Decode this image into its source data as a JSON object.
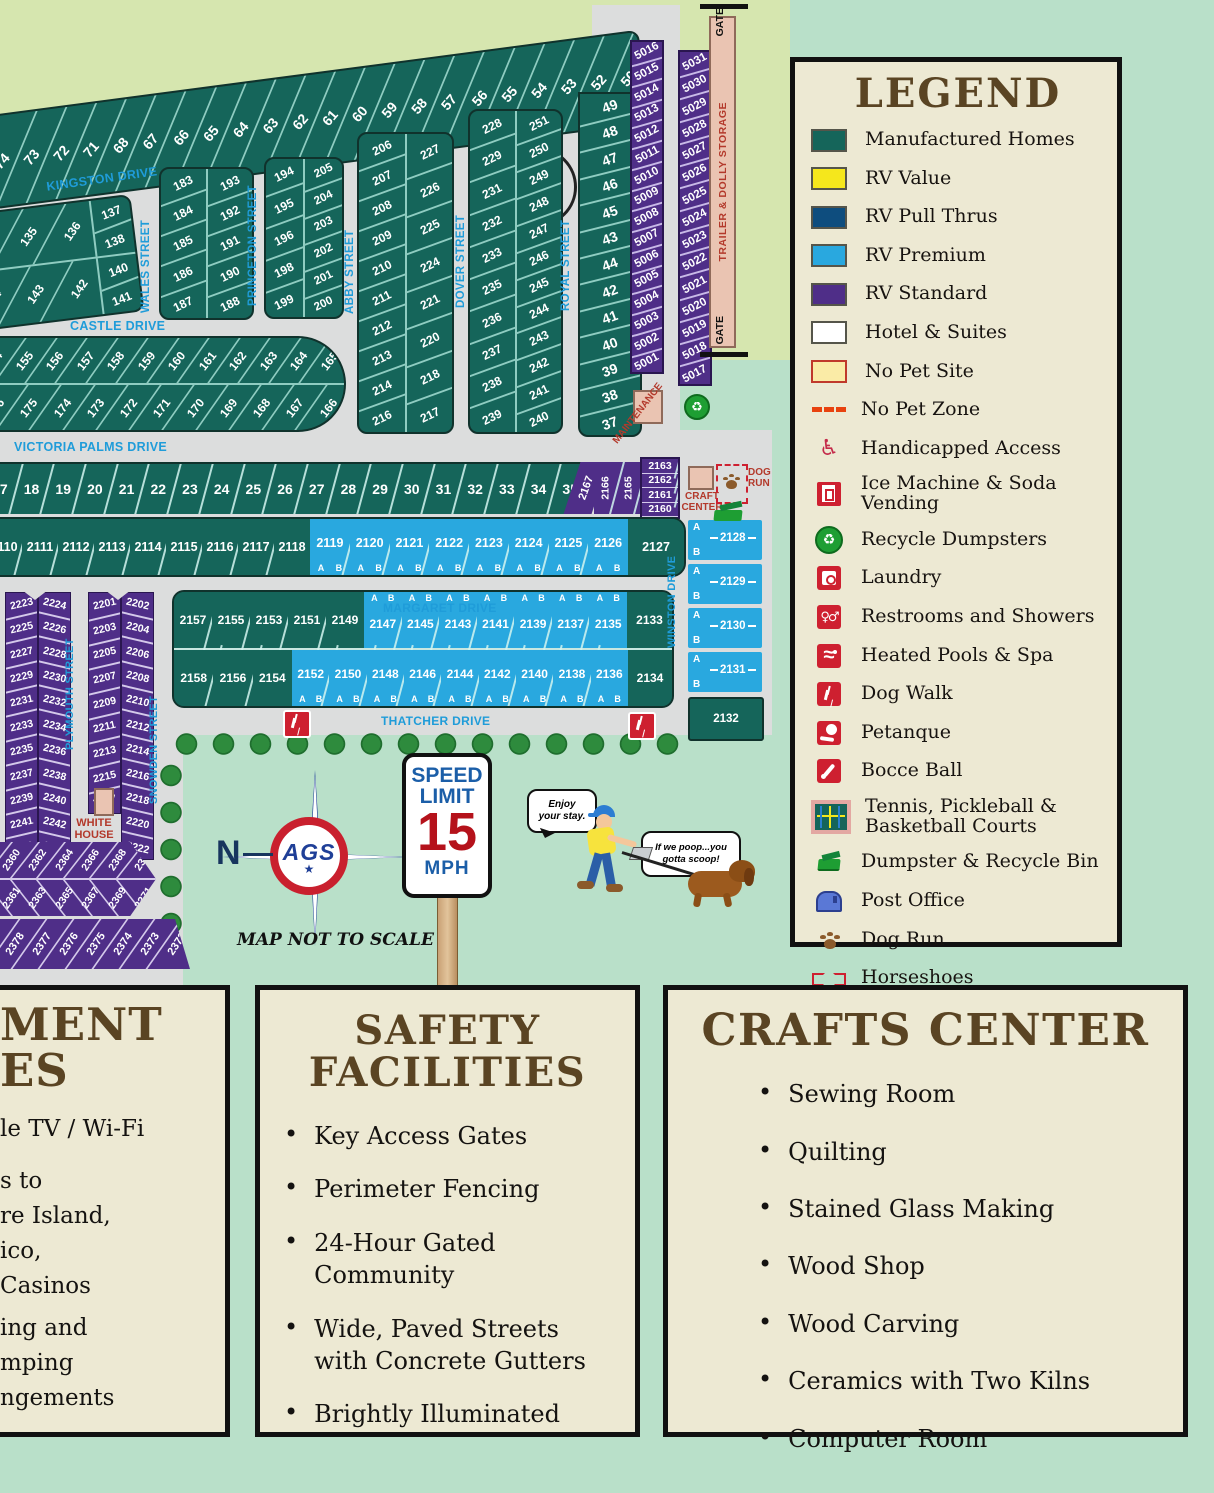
{
  "colors": {
    "manufactured_homes": "#15655A",
    "rv_value": "#F5E71C",
    "rv_pull_thrus": "#0E4D7E",
    "rv_premium": "#29A8DF",
    "rv_standard": "#4F2E88",
    "hotel_suites": "#FFFFFF",
    "no_pet_site": "#FAEBA6",
    "no_pet_zone": "#E8420F",
    "road": "#DCDDDD",
    "background": "#B9E0C9",
    "outside_band": "#D6E6AF",
    "street_label": "#1F9CD9",
    "heading_brown": "#5A4423",
    "panel_cream": "#EDE9D3",
    "icon_red": "#CE2030",
    "building_pink": "#EAC4B2",
    "building_label_red": "#B3392B"
  },
  "legend": {
    "title": "LEGEND",
    "items": [
      {
        "label": "Manufactured Homes",
        "icon": "ic-manufactured"
      },
      {
        "label": "RV Value",
        "icon": "ic-rv-value"
      },
      {
        "label": "RV Pull Thrus",
        "icon": "ic-rv-pull"
      },
      {
        "label": "RV Premium",
        "icon": "ic-rv-premium"
      },
      {
        "label": "RV Standard",
        "icon": "ic-rv-standard"
      },
      {
        "label": "Hotel & Suites",
        "icon": "ic-hotel"
      },
      {
        "label": "No Pet Site",
        "icon": "ic-no-pet-site"
      },
      {
        "label": "No Pet Zone",
        "icon": "ic-no-pet-zone"
      },
      {
        "label": "Handicapped Access",
        "icon": "ic-handicap"
      },
      {
        "label": "Ice Machine & Soda Vending",
        "icon": "ic-ice"
      },
      {
        "label": "Recycle Dumpsters",
        "icon": "ic-recycle"
      },
      {
        "label": "Laundry",
        "icon": "ic-laundry"
      },
      {
        "label": "Restrooms and Showers",
        "icon": "ic-restroom"
      },
      {
        "label": "Heated Pools & Spa",
        "icon": "ic-pool"
      },
      {
        "label": "Dog Walk",
        "icon": "ic-dogwalk"
      },
      {
        "label": "Petanque",
        "icon": "ic-petanque"
      },
      {
        "label": "Bocce Ball",
        "icon": "ic-bocce"
      },
      {
        "label": "Tennis, Pickleball & Basketball Courts",
        "icon": "ic-courts"
      },
      {
        "label": "Dumpster & Recycle Bin",
        "icon": "ic-dumpster"
      },
      {
        "label": "Post Office",
        "icon": "ic-post"
      },
      {
        "label": "Dog Run",
        "icon": "ic-dogrun"
      },
      {
        "label": "Horseshoes",
        "icon": "ic-horseshoe"
      }
    ]
  },
  "streets": {
    "kingston": "KINGSTON DRIVE",
    "wales": "WALES STREET",
    "princeton": "PRINCETON STREET",
    "abby": "ABBY STREET",
    "dover": "DOVER STREET",
    "royal": "ROYAL STREET",
    "castle": "CASTLE DRIVE",
    "victoria": "VICTORIA PALMS DRIVE",
    "margaret": "MARGARET DRIVE",
    "thatcher": "THATCHER DRIVE",
    "winston": "WINSTON DRIVE",
    "plymouth": "PLYMOUTH STREET",
    "snowden": "SNOWDEN STREET"
  },
  "facilities": {
    "gate_top": "GATE",
    "gate_bottom": "GATE",
    "trailer_storage": "TRAILER & DOLLY STORAGE",
    "maintenance": "MAINTENANCE",
    "craft_center": "CRAFT\nCENTER",
    "dog_run": "DOG\nRUN",
    "white_house": "WHITE\nHOUSE"
  },
  "ab": [
    "A",
    "B"
  ],
  "lots": {
    "top_row": [
      "74",
      "73",
      "72",
      "71",
      "68",
      "67",
      "66",
      "65",
      "64",
      "63",
      "62",
      "61",
      "60",
      "59",
      "58",
      "57",
      "56",
      "55",
      "54",
      "53",
      "52",
      "50"
    ],
    "royal_column": [
      "49",
      "48",
      "47",
      "46",
      "45",
      "43",
      "44",
      "42",
      "41",
      "40",
      "39",
      "38",
      "37"
    ],
    "col_5000_west": [
      "5016",
      "5015",
      "5014",
      "5013",
      "5012",
      "5011",
      "5010",
      "5009",
      "5008",
      "5007",
      "5006",
      "5005",
      "5004",
      "5003",
      "5002",
      "5001"
    ],
    "col_5000_east": [
      "5031",
      "5030",
      "5029",
      "5028",
      "5027",
      "5026",
      "5025",
      "5024",
      "5023",
      "5022",
      "5021",
      "5020",
      "5019",
      "5018",
      "5017"
    ],
    "kingston_block": {
      "row_a": [
        "134",
        "135",
        "136"
      ],
      "right_a": [
        "137",
        "138"
      ],
      "row_b": [
        "144",
        "143",
        "142"
      ],
      "right_b": [
        "140",
        "141"
      ]
    },
    "wales_block": {
      "left": [
        "183",
        "184",
        "185",
        "186",
        "187"
      ],
      "right": [
        "193",
        "192",
        "191",
        "190",
        "188"
      ]
    },
    "princeton_block": {
      "left": [
        "194",
        "195",
        "196",
        "198",
        "199"
      ],
      "right": [
        "205",
        "204",
        "203",
        "202",
        "201",
        "200"
      ]
    },
    "abby_block": {
      "left": [
        "206",
        "207",
        "208",
        "209",
        "210",
        "211",
        "212",
        "213",
        "214",
        "216"
      ],
      "right": [
        "227",
        "226",
        "225",
        "224",
        "221",
        "220",
        "218",
        "217"
      ]
    },
    "dover_block": {
      "left": [
        "228",
        "229",
        "231",
        "232",
        "233",
        "235",
        "236",
        "237",
        "238",
        "239"
      ],
      "right": [
        "251",
        "250",
        "249",
        "248",
        "247",
        "246",
        "245",
        "244",
        "243",
        "242",
        "241",
        "240"
      ]
    },
    "castle_row_top": [
      "154",
      "155",
      "156",
      "157",
      "158",
      "159",
      "160",
      "161",
      "162",
      "163",
      "164",
      "165"
    ],
    "castle_row_bottom": [
      "176",
      "175",
      "174",
      "173",
      "172",
      "171",
      "170",
      "169",
      "168",
      "167",
      "166"
    ],
    "victoria_row": [
      "17",
      "18",
      "19",
      "20",
      "21",
      "22",
      "23",
      "24",
      "25",
      "26",
      "27",
      "28",
      "29",
      "30",
      "31",
      "32",
      "33",
      "34",
      "35"
    ],
    "purple_2167": "2167",
    "purple_vertical": [
      "2166",
      "2165",
      "2164"
    ],
    "purple_stack": [
      "2163",
      "2162",
      "2161",
      "2160"
    ],
    "row_2110_teal": [
      "2110",
      "2111",
      "2112",
      "2113",
      "2114",
      "2115",
      "2116",
      "2117",
      "2118"
    ],
    "row_2110_blue": [
      "2119",
      "2120",
      "2121",
      "2122",
      "2123",
      "2124",
      "2125",
      "2126"
    ],
    "row_2110_end": "2127",
    "south_top_teal": [
      "2157",
      "2155",
      "2153",
      "2151",
      "2149"
    ],
    "south_top_blue": [
      "2147",
      "2145",
      "2143",
      "2141",
      "2139",
      "2137",
      "2135"
    ],
    "south_top_end": "2133",
    "south_bottom_teal": [
      "2158",
      "2156",
      "2154"
    ],
    "south_bottom_blue": [
      "2152",
      "2150",
      "2148",
      "2146",
      "2144",
      "2142",
      "2140",
      "2138",
      "2136"
    ],
    "south_bottom_end": "2134",
    "winston_column": [
      "2128",
      "2129",
      "2130",
      "2131"
    ],
    "winston_end": "2132",
    "plymouth_west": [
      "2223",
      "2225",
      "2227",
      "2229",
      "2231",
      "2233",
      "2235",
      "2237",
      "2239",
      "2241",
      "2243"
    ],
    "plymouth_east": [
      "2224",
      "2226",
      "2228",
      "2230",
      "2232",
      "2234",
      "2236",
      "2238",
      "2240",
      "2242",
      "2244"
    ],
    "snowden_west": [
      "2201",
      "2203",
      "2205",
      "2207",
      "2209",
      "2211",
      "2213",
      "2215",
      "2217"
    ],
    "snowden_east": [
      "2202",
      "2204",
      "2206",
      "2208",
      "2210",
      "2212",
      "2214",
      "2216",
      "2218",
      "2220",
      "2222"
    ],
    "chevron_top": [
      "2358",
      "2360",
      "2362",
      "2364",
      "2366",
      "2368",
      "2370"
    ],
    "chevron_bottom": [
      "2359",
      "2361",
      "2363",
      "2365",
      "2367",
      "2369",
      "2371"
    ],
    "bottom_row": [
      "2379",
      "2378",
      "2377",
      "2376",
      "2375",
      "2374",
      "2373",
      "2372"
    ]
  },
  "annotations": {
    "north": "N",
    "compass_logo": "AGS",
    "compass_star": "★",
    "not_to_scale": "MAP NOT TO SCALE",
    "speed_sign": {
      "line1": "SPEED",
      "line2": "LIMIT",
      "value": "15",
      "unit": "MPH"
    },
    "bubble_man": "Enjoy\nyour stay.",
    "bubble_dog": "If we poop...you\ngotta scoop!"
  },
  "info_boxes": {
    "bullet": "•",
    "left_partial": {
      "title_fragments": [
        "MENT",
        "ES"
      ],
      "line_fragments": [
        "le TV / Wi-Fi",
        "s to",
        "re Island,",
        "ico,",
        "Casinos",
        "ing and",
        "mping",
        "ngements"
      ]
    },
    "safety": {
      "title": "SAFETY\nFACILITIES",
      "bullets": [
        "Key Access Gates",
        "Perimeter Fencing",
        "24-Hour Gated\nCommunity",
        "Wide, Paved Streets\nwith Concrete Gutters",
        "Brightly Illuminated"
      ]
    },
    "crafts": {
      "title": "CRAFTS CENTER",
      "bullets": [
        "Sewing Room",
        "Quilting",
        "Stained Glass Making",
        "Wood Shop",
        "Wood Carving",
        "Ceramics with Two Kilns",
        "Computer Room"
      ]
    }
  }
}
